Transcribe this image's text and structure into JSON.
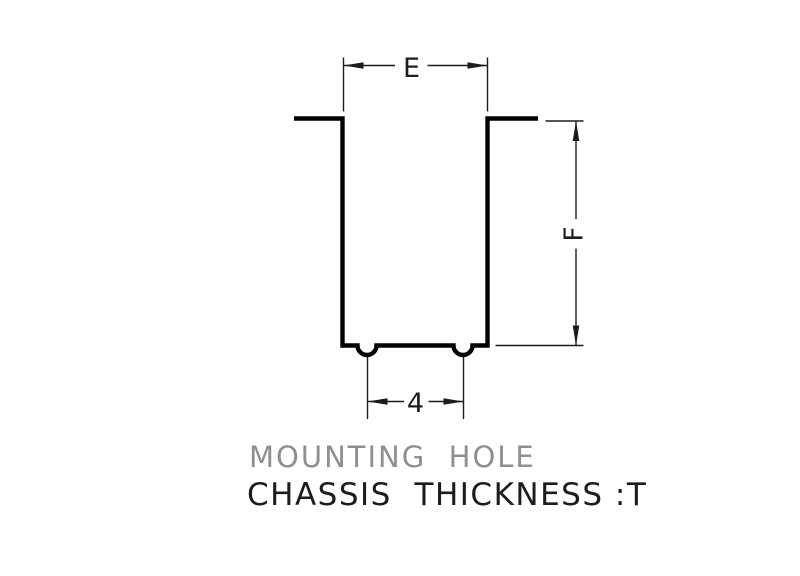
{
  "drawing": {
    "caption": {
      "line1": "MOUNTING  HOLE",
      "line2": "CHASSIS  THICKNESS :T"
    },
    "dimensions": {
      "hole_width_label": "E",
      "hole_depth_label": "F",
      "bump_pitch_label": "4"
    },
    "colors": {
      "background": "#ffffff",
      "outline": "#000000",
      "dimension": "#1c1c1c",
      "caption_primary": "#1c1c1c",
      "caption_secondary": "#8f8f8f"
    }
  }
}
